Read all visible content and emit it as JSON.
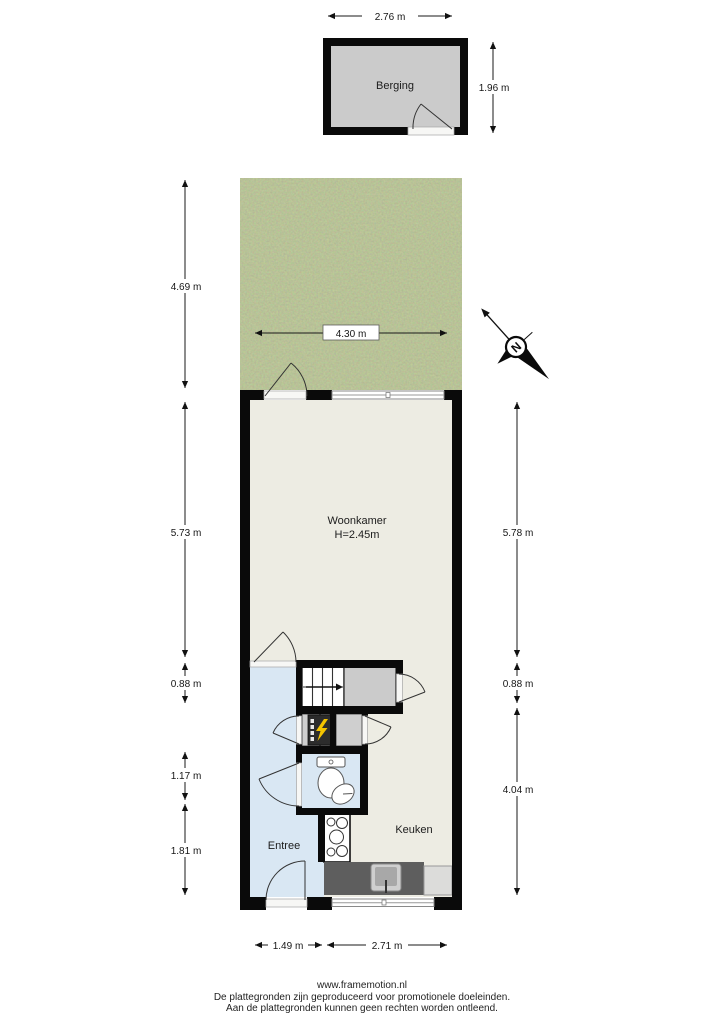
{
  "labels": {
    "berging": "Berging",
    "woonkamer": "Woonkamer",
    "woonkamer_ceiling": "H=2.45m",
    "entree": "Entree",
    "keuken": "Keuken",
    "compass_north": "N"
  },
  "dimensions": {
    "berging_width": "2.76 m",
    "berging_depth": "1.96 m",
    "garden_depth": "4.69 m",
    "garden_width": "4.30 m",
    "left": [
      "5.73 m",
      "0.88 m",
      "1.17 m",
      "1.81 m"
    ],
    "right": [
      "5.78 m",
      "0.88 m",
      "4.04 m"
    ],
    "bottom": [
      "1.49 m",
      "2.71 m"
    ]
  },
  "footer": {
    "website": "www.framemotion.nl",
    "disclaimer_line1": "De plattegronden zijn geproduceerd voor promotionele doeleinden.",
    "disclaimer_line2": "Aan de plattegronden kunnen geen rechten worden ontleend."
  },
  "colors": {
    "wall": "#0a0a0a",
    "floor_cream": "#edece3",
    "floor_blue": "#d9e7f3",
    "floor_gray": "#cbcbcb",
    "grass_green": "#7b8a4f",
    "counter_gray": "#5e5e5e",
    "bolt_yellow": "#f4c400"
  }
}
